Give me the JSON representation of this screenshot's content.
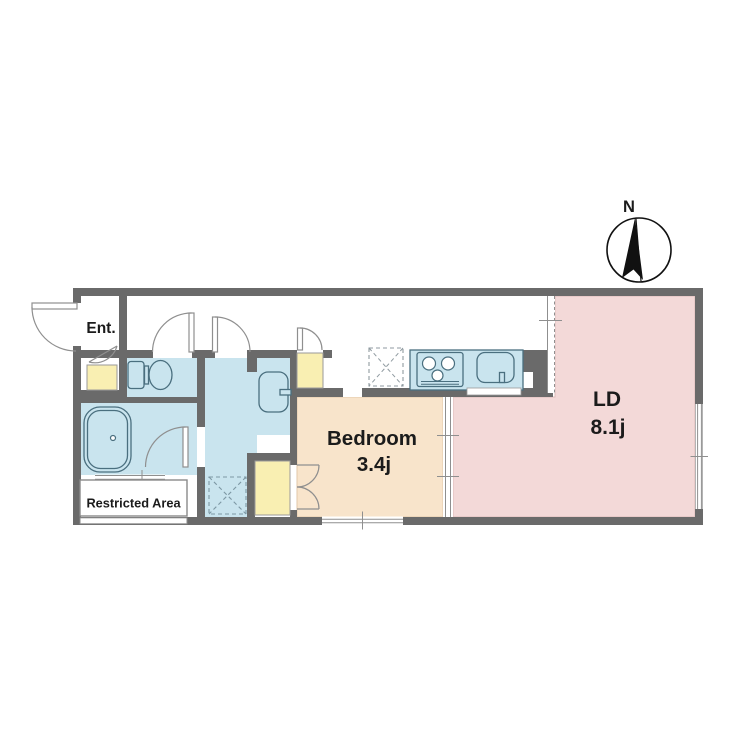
{
  "compass": {
    "label": "N"
  },
  "rooms": {
    "entrance": {
      "label": "Ent."
    },
    "bedroom": {
      "label": "Bedroom",
      "area": "3.4j"
    },
    "living_dining": {
      "label": "LD",
      "area": "8.1j"
    },
    "restricted_area": {
      "label": "Restricted Area"
    }
  },
  "fixtures": [
    "toilet",
    "bathtub",
    "washbasin",
    "kitchen-stove",
    "kitchen-sink",
    "washing-machine-space",
    "refrigerator-space",
    "shoe-cabinet",
    "hall-closet",
    "bedroom-closet",
    "sliding-partition",
    "windows"
  ],
  "colors": {
    "wall": "#6a6a6a",
    "wet_area": "#c9e4ee",
    "fixture_line": "#4a6f7f",
    "bedroom": "#f8e4cb",
    "living": "#f3d9d8",
    "storage": "#f9efb2",
    "door_line": "#8f8f8f",
    "text": "#1b1b1b"
  }
}
